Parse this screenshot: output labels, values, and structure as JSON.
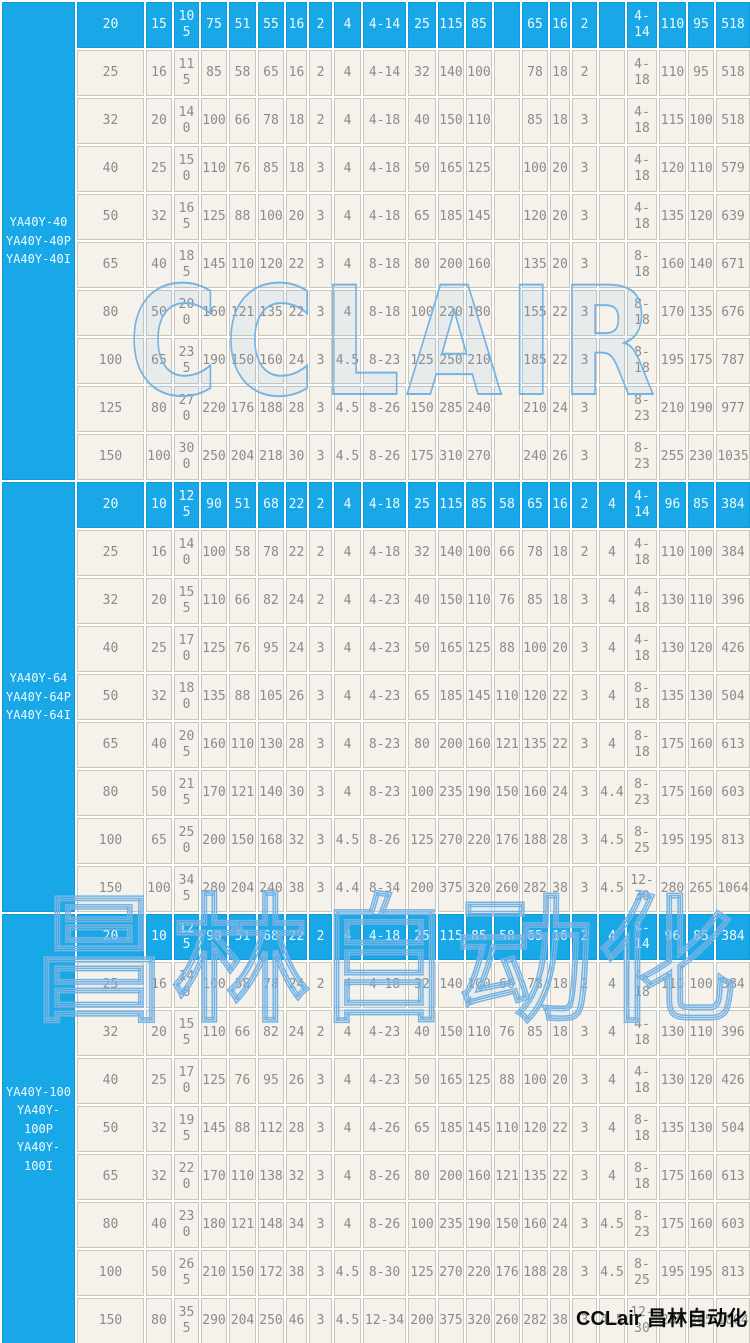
{
  "colors": {
    "highlight_row": "#18a8e8",
    "highlight_text": "#eefaff",
    "cell_background": "#f5f2ec",
    "grid_line": "#cbc7ba",
    "cell_text": "#8b8b8b",
    "watermark_blue": "#75b3e3",
    "brand_text": "#0c0c0c"
  },
  "watermarks": {
    "latin": "CCLAIR",
    "cjk": "昌林自动化",
    "footer": "CCLair 昌林自动化"
  },
  "table": {
    "groups": [
      {
        "model_lines": [
          "YA40Y-40",
          "YA40Y-40P",
          "YA40Y-40I"
        ],
        "rows": [
          {
            "highlight": true,
            "cells": [
              "20",
              "15",
              "105",
              "75",
              "51",
              "55",
              "16",
              "2",
              "4",
              "4-14",
              "25",
              "115",
              "85",
              "",
              "65",
              "16",
              "2",
              "",
              "4-14",
              "110",
              "95",
              "518"
            ]
          },
          {
            "highlight": false,
            "cells": [
              "25",
              "16",
              "115",
              "85",
              "58",
              "65",
              "16",
              "2",
              "4",
              "4-14",
              "32",
              "140",
              "100",
              "",
              "78",
              "18",
              "2",
              "",
              "4-18",
              "110",
              "95",
              "518"
            ]
          },
          {
            "highlight": false,
            "cells": [
              "32",
              "20",
              "140",
              "100",
              "66",
              "78",
              "18",
              "2",
              "4",
              "4-18",
              "40",
              "150",
              "110",
              "",
              "85",
              "18",
              "3",
              "",
              "4-18",
              "115",
              "100",
              "518"
            ]
          },
          {
            "highlight": false,
            "cells": [
              "40",
              "25",
              "150",
              "110",
              "76",
              "85",
              "18",
              "3",
              "4",
              "4-18",
              "50",
              "165",
              "125",
              "",
              "100",
              "20",
              "3",
              "",
              "4-18",
              "120",
              "110",
              "579"
            ]
          },
          {
            "highlight": false,
            "cells": [
              "50",
              "32",
              "165",
              "125",
              "88",
              "100",
              "20",
              "3",
              "4",
              "4-18",
              "65",
              "185",
              "145",
              "",
              "120",
              "20",
              "3",
              "",
              "4-18",
              "135",
              "120",
              "639"
            ]
          },
          {
            "highlight": false,
            "cells": [
              "65",
              "40",
              "185",
              "145",
              "110",
              "120",
              "22",
              "3",
              "4",
              "8-18",
              "80",
              "200",
              "160",
              "",
              "135",
              "20",
              "3",
              "",
              "8-18",
              "160",
              "140",
              "671"
            ]
          },
          {
            "highlight": false,
            "cells": [
              "80",
              "50",
              "200",
              "160",
              "121",
              "135",
              "22",
              "3",
              "4",
              "8-18",
              "100",
              "220",
              "180",
              "",
              "155",
              "22",
              "3",
              "",
              "8-18",
              "170",
              "135",
              "676"
            ]
          },
          {
            "highlight": false,
            "cells": [
              "100",
              "65",
              "235",
              "190",
              "150",
              "160",
              "24",
              "3",
              "4.5",
              "8-23",
              "125",
              "250",
              "210",
              "",
              "185",
              "22",
              "3",
              "",
              "8-18",
              "195",
              "175",
              "787"
            ]
          },
          {
            "highlight": false,
            "cells": [
              "125",
              "80",
              "270",
              "220",
              "176",
              "188",
              "28",
              "3",
              "4.5",
              "8-26",
              "150",
              "285",
              "240",
              "",
              "210",
              "24",
              "3",
              "",
              "8-23",
              "210",
              "190",
              "977"
            ]
          },
          {
            "highlight": false,
            "cells": [
              "150",
              "100",
              "300",
              "250",
              "204",
              "218",
              "30",
              "3",
              "4.5",
              "8-26",
              "175",
              "310",
              "270",
              "",
              "240",
              "26",
              "3",
              "",
              "8-23",
              "255",
              "230",
              "1035"
            ]
          }
        ]
      },
      {
        "model_lines": [
          "YA40Y-64",
          "YA40Y-64P",
          "YA40Y-64I"
        ],
        "rows": [
          {
            "highlight": true,
            "cells": [
              "20",
              "10",
              "125",
              "90",
              "51",
              "68",
              "22",
              "2",
              "4",
              "4-18",
              "25",
              "115",
              "85",
              "58",
              "65",
              "16",
              "2",
              "4",
              "4-14",
              "96",
              "85",
              "384"
            ]
          },
          {
            "highlight": false,
            "cells": [
              "25",
              "16",
              "140",
              "100",
              "58",
              "78",
              "22",
              "2",
              "4",
              "4-18",
              "32",
              "140",
              "100",
              "66",
              "78",
              "18",
              "2",
              "4",
              "4-18",
              "110",
              "100",
              "384"
            ]
          },
          {
            "highlight": false,
            "cells": [
              "32",
              "20",
              "155",
              "110",
              "66",
              "82",
              "24",
              "2",
              "4",
              "4-23",
              "40",
              "150",
              "110",
              "76",
              "85",
              "18",
              "3",
              "4",
              "4-18",
              "130",
              "110",
              "396"
            ]
          },
          {
            "highlight": false,
            "cells": [
              "40",
              "25",
              "170",
              "125",
              "76",
              "95",
              "24",
              "3",
              "4",
              "4-23",
              "50",
              "165",
              "125",
              "88",
              "100",
              "20",
              "3",
              "4",
              "4-18",
              "130",
              "120",
              "426"
            ]
          },
          {
            "highlight": false,
            "cells": [
              "50",
              "32",
              "180",
              "135",
              "88",
              "105",
              "26",
              "3",
              "4",
              "4-23",
              "65",
              "185",
              "145",
              "110",
              "120",
              "22",
              "3",
              "4",
              "8-18",
              "135",
              "130",
              "504"
            ]
          },
          {
            "highlight": false,
            "cells": [
              "65",
              "40",
              "205",
              "160",
              "110",
              "130",
              "28",
              "3",
              "4",
              "8-23",
              "80",
              "200",
              "160",
              "121",
              "135",
              "22",
              "3",
              "4",
              "8-18",
              "175",
              "160",
              "613"
            ]
          },
          {
            "highlight": false,
            "cells": [
              "80",
              "50",
              "215",
              "170",
              "121",
              "140",
              "30",
              "3",
              "4",
              "8-23",
              "100",
              "235",
              "190",
              "150",
              "160",
              "24",
              "3",
              "4.4",
              "8-23",
              "175",
              "160",
              "603"
            ]
          },
          {
            "highlight": false,
            "cells": [
              "100",
              "65",
              "250",
              "200",
              "150",
              "168",
              "32",
              "3",
              "4.5",
              "8-26",
              "125",
              "270",
              "220",
              "176",
              "188",
              "28",
              "3",
              "4.5",
              "8-25",
              "195",
              "195",
              "813"
            ]
          },
          {
            "highlight": false,
            "cells": [
              "150",
              "100",
              "345",
              "280",
              "204",
              "240",
              "38",
              "3",
              "4.4",
              "8-34",
              "200",
              "375",
              "320",
              "260",
              "282",
              "38",
              "3",
              "4.5",
              "12-30",
              "280",
              "265",
              "1064"
            ]
          }
        ]
      },
      {
        "model_lines": [
          "YA40Y-100",
          "YA40Y-100P",
          "YA40Y-100I"
        ],
        "rows": [
          {
            "highlight": true,
            "cells": [
              "20",
              "10",
              "125",
              "90",
              "51",
              "68",
              "22",
              "2",
              "4",
              "4-18",
              "25",
              "115",
              "85",
              "58",
              "65",
              "16",
              "2",
              "4",
              "4-14",
              "96",
              "85",
              "384"
            ]
          },
          {
            "highlight": false,
            "cells": [
              "25",
              "16",
              "140",
              "100",
              "58",
              "78",
              "24",
              "2",
              "4",
              "4-18",
              "32",
              "140",
              "100",
              "66",
              "78",
              "18",
              "2",
              "4",
              "4-18",
              "110",
              "100",
              "384"
            ]
          },
          {
            "highlight": false,
            "cells": [
              "32",
              "20",
              "155",
              "110",
              "66",
              "82",
              "24",
              "2",
              "4",
              "4-23",
              "40",
              "150",
              "110",
              "76",
              "85",
              "18",
              "3",
              "4",
              "4-18",
              "130",
              "110",
              "396"
            ]
          },
          {
            "highlight": false,
            "cells": [
              "40",
              "25",
              "170",
              "125",
              "76",
              "95",
              "26",
              "3",
              "4",
              "4-23",
              "50",
              "165",
              "125",
              "88",
              "100",
              "20",
              "3",
              "4",
              "4-18",
              "130",
              "120",
              "426"
            ]
          },
          {
            "highlight": false,
            "cells": [
              "50",
              "32",
              "195",
              "145",
              "88",
              "112",
              "28",
              "3",
              "4",
              "4-26",
              "65",
              "185",
              "145",
              "110",
              "120",
              "22",
              "3",
              "4",
              "8-18",
              "135",
              "130",
              "504"
            ]
          },
          {
            "highlight": false,
            "cells": [
              "65",
              "32",
              "220",
              "170",
              "110",
              "138",
              "32",
              "3",
              "4",
              "8-26",
              "80",
              "200",
              "160",
              "121",
              "135",
              "22",
              "3",
              "4",
              "8-18",
              "175",
              "160",
              "613"
            ]
          },
          {
            "highlight": false,
            "cells": [
              "80",
              "40",
              "230",
              "180",
              "121",
              "148",
              "34",
              "3",
              "4",
              "8-26",
              "100",
              "235",
              "190",
              "150",
              "160",
              "24",
              "3",
              "4.5",
              "8-23",
              "175",
              "160",
              "603"
            ]
          },
          {
            "highlight": false,
            "cells": [
              "100",
              "50",
              "265",
              "210",
              "150",
              "172",
              "38",
              "3",
              "4.5",
              "8-30",
              "125",
              "270",
              "220",
              "176",
              "188",
              "28",
              "3",
              "4.5",
              "8-25",
              "195",
              "195",
              "813"
            ]
          },
          {
            "highlight": false,
            "cells": [
              "150",
              "80",
              "355",
              "290",
              "204",
              "250",
              "46",
              "3",
              "4.5",
              "12-34",
              "200",
              "375",
              "320",
              "260",
              "282",
              "38",
              "3",
              "4.5",
              "12-30",
              "280",
              "265",
              "1064"
            ]
          }
        ]
      }
    ]
  }
}
